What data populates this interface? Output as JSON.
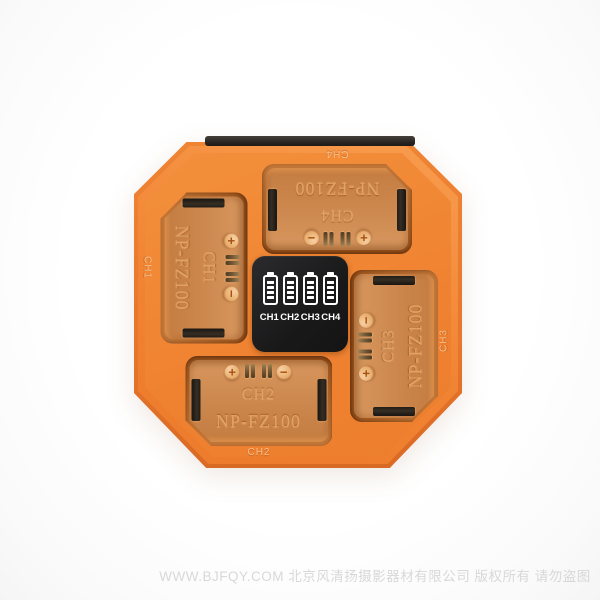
{
  "device": {
    "type": "four-channel camera battery charger, top view product photo",
    "colors": {
      "body_orange": "#ef8231",
      "body_edge": "#d96a24",
      "slot_tray": "#cd8950",
      "engraved_text": "#e2a264",
      "display_bg": "#19191a",
      "display_fg": "#ffffff",
      "back_edge": "#262220"
    },
    "symbols": {
      "plus": "+",
      "minus": "−"
    },
    "slots": [
      {
        "channel": "CH1",
        "model": "NP-FZ100",
        "rim_label": "CH1"
      },
      {
        "channel": "CH2",
        "model": "NP-FZ100",
        "rim_label": "CH2"
      },
      {
        "channel": "CH3",
        "model": "NP-FZ100",
        "rim_label": "CH3"
      },
      {
        "channel": "CH4",
        "model": "NP-FZ100",
        "rim_label": "CH4"
      }
    ],
    "display": {
      "channels": [
        "CH1",
        "CH2",
        "CH3",
        "CH4"
      ],
      "battery_segments": 4
    }
  },
  "watermark": {
    "text": "WWW.BJFQY.COM 北京风清扬摄影器材有限公司 版权所有 请勿盗图"
  }
}
